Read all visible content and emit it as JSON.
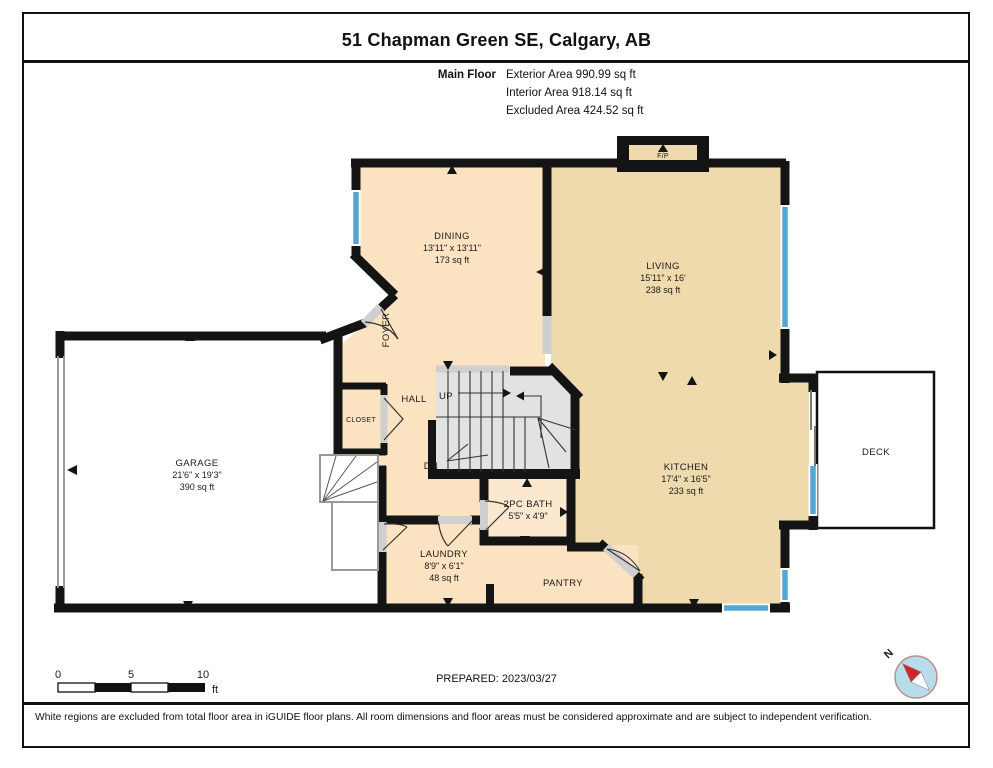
{
  "title": "51 Chapman Green SE, Calgary, AB",
  "floor_summary": {
    "floor_label": "Main Floor",
    "lines": [
      "Exterior Area 990.99 sq ft",
      "Interior Area 918.14 sq ft",
      "Excluded Area 424.52 sq ft"
    ]
  },
  "rooms": {
    "dining": {
      "name": "DINING",
      "dims": "13'11\" x 13'11\"",
      "area": "173 sq ft"
    },
    "living": {
      "name": "LIVING",
      "dims": "15'11\" x 16'",
      "area": "238 sq ft"
    },
    "kitchen": {
      "name": "KITCHEN",
      "dims": "17'4\" x 16'5\"",
      "area": "233 sq ft"
    },
    "garage": {
      "name": "GARAGE",
      "dims": "21'6\" x 19'3\"",
      "area": "390 sq ft"
    },
    "laundry": {
      "name": "LAUNDRY",
      "dims": "8'9\" x 6'1\"",
      "area": "48 sq ft"
    },
    "bath": {
      "name": "2PC BATH",
      "dims": "5'5\" x 4'9\""
    },
    "foyer": {
      "name": "FOYER"
    },
    "hall": {
      "name": "HALL"
    },
    "closet": {
      "name": "CLOSET"
    },
    "pantry": {
      "name": "PANTRY"
    },
    "deck": {
      "name": "DECK"
    },
    "fireplace": {
      "name": "F/P"
    }
  },
  "stairs": {
    "up_label": "UP",
    "dn_label": "DN"
  },
  "scale_bar": {
    "ticks": [
      "0",
      "5",
      "10"
    ],
    "unit": "ft"
  },
  "prepared": "PREPARED: 2023/03/27",
  "compass": {
    "north_label": "N"
  },
  "disclaimer": "White regions are excluded from total floor area in iGUIDE floor plans. All room dimensions and floor areas must be considered approximate and are subject to independent verification.",
  "colors": {
    "room_peach": "#fbe3c2",
    "room_tan": "#eedaad",
    "bath_peach": "#fbe8cf",
    "window_blue": "#54a7d5",
    "wall_black": "#141414",
    "stair_gray": "#e2e2e2",
    "casing_gray": "#cfcfcf",
    "compass_blue": "#b9dcea",
    "compass_red": "#d6222a"
  }
}
